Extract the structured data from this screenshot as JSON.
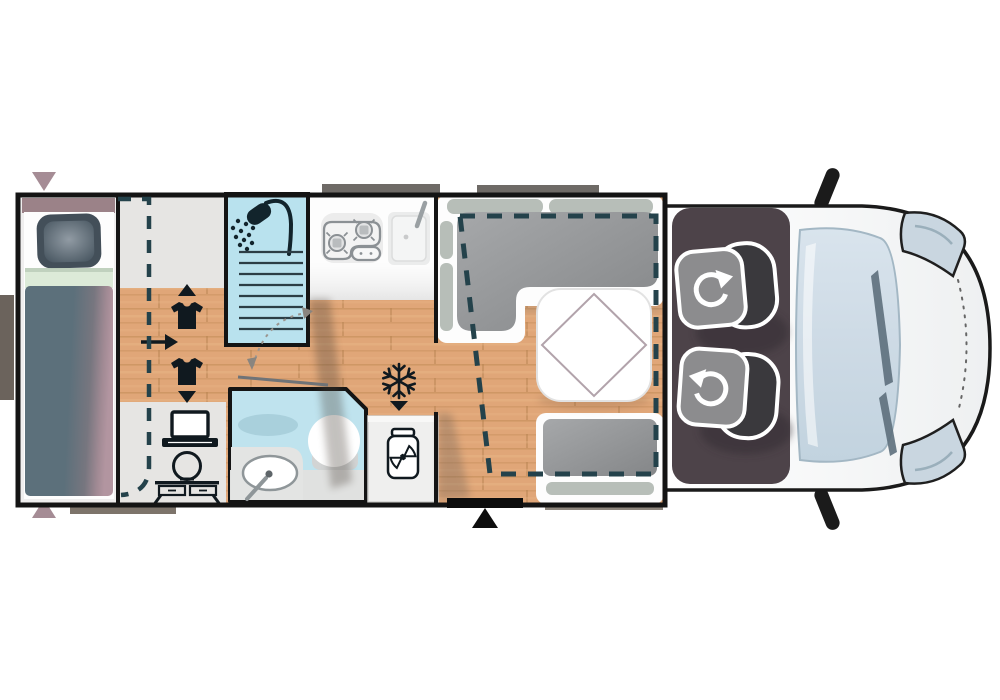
{
  "scene": {
    "type": "motorhome-floorplan-top-view",
    "vehicle_front_direction": "right"
  },
  "palette": {
    "wood_floor": "#e0a678",
    "grey_floor": "#e6e5e3",
    "shower_blue": "#b9e2ee",
    "bathroom_blue": "#bfe3ee",
    "cushion_grey_light": "#a6a8aa",
    "cushion_grey_dark": "#848688",
    "cushion_sage": "#b7beb8",
    "duvet_slate": "#5c707b",
    "duvet_mauve": "#b295a0",
    "headboard_mauve": "#9b8288",
    "cab_floor": "#4d4349",
    "seat_back": "#3a393d",
    "seat_base": "#8c8c8e",
    "vehicle_body": "#fbfcfc",
    "windshield": "#cddae5",
    "headlight": "#c9d6e0",
    "dash_line": "#24424b",
    "marker_mauve": "#a58c95",
    "exterior_grey": "#6e6a66",
    "step_grey": "#8e867d",
    "hatch_grey": "#7d746b",
    "icon_dark": "#10191f",
    "stove_grey": "#8b9094",
    "table_diamond": "#b2a3ab",
    "wall_black": "#141414",
    "entry_black": "#0d0d0d"
  },
  "features": {
    "bedroom": [
      "single-bed",
      "pillow",
      "duvet",
      "sliding-partition-dashed"
    ],
    "corridor": [
      "wardrobe-shirt-up",
      "wardrobe-shirt-down",
      "direction-arrow",
      "laptop-desk",
      "vanity-table"
    ],
    "washroom": [
      "shower-cabin",
      "washbasin",
      "toilet",
      "swing-door-arc"
    ],
    "kitchen": [
      "two-burner-hob",
      "kitchen-sink",
      "fridge-snowflake",
      "pantry-jar"
    ],
    "dinette": [
      "l-shaped-sofa",
      "dinette-table",
      "bench-seat",
      "drop-down-bed-dashed"
    ],
    "cab": [
      "driver-swivel-seat",
      "passenger-swivel-seat",
      "windshield",
      "headlight-top",
      "headlight-bottom",
      "mirror-top",
      "mirror-bottom"
    ],
    "markers": [
      "entrance-triangle",
      "window-marker-top",
      "window-marker-bottom",
      "exterior-hatch-left",
      "exterior-hatch-bottom",
      "exterior-step"
    ]
  }
}
